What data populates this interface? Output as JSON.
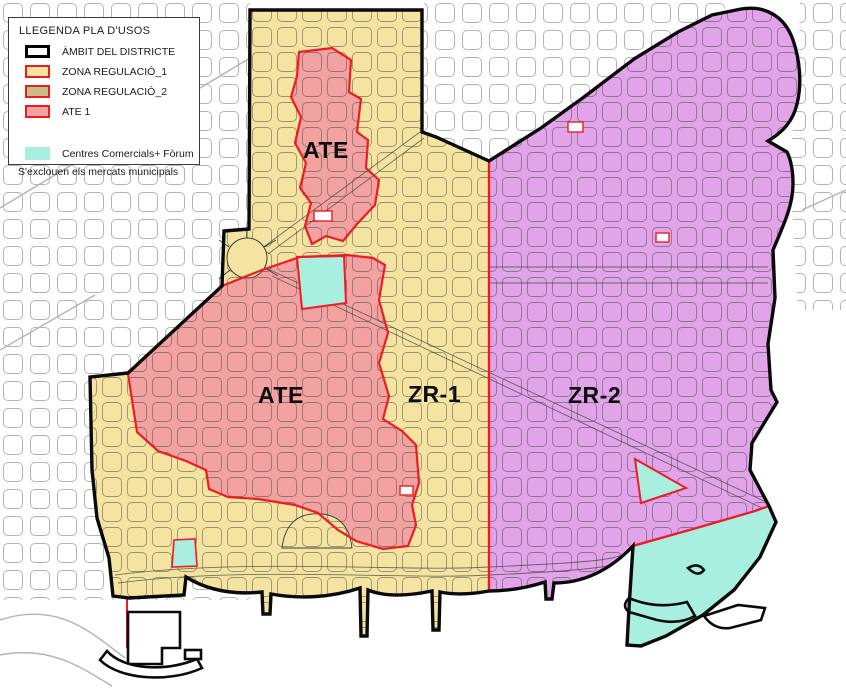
{
  "legend": {
    "title": "LLEGENDA PLA D'USOS",
    "items": [
      {
        "label": "ÀMBIT DEL DISTRICTE",
        "swatch": "district-outline"
      },
      {
        "label": "ZONA REGULACIÓ_1",
        "swatch": "zone-regulation-1"
      },
      {
        "label": "ZONA REGULACIÓ_2",
        "swatch": "zone-regulation-2"
      },
      {
        "label": "ATE 1",
        "swatch": "ate-1"
      }
    ],
    "commercial_item": {
      "label": "Centres Comercials+ Fòrum",
      "swatch": "commercial-forum"
    },
    "note": "S'exclouen els mercats municipals"
  },
  "map": {
    "labels": {
      "ate_upper": "ATE",
      "ate_main": "ATE",
      "zr1": "ZR-1",
      "zr2": "ZR-2"
    }
  },
  "colors": {
    "zone_regulation_1_fill": "#F5E4A1",
    "zone_regulation_2_fill": "#E2A4E8",
    "zone_regulation_2_legend_swatch": "#C9BC84",
    "ate_fill": "#F2A3A1",
    "commercial_fill": "#A9EFDF",
    "regulation_border": "#ED1C24",
    "district_border": "#000000",
    "outside_street_grid": "#B3B3B3",
    "inner_street_grid": "#3D3D3D"
  }
}
